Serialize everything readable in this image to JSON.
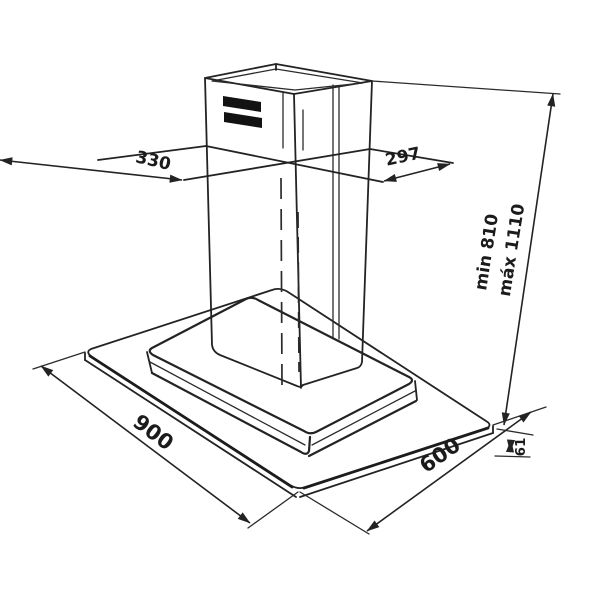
{
  "diagram": {
    "background": "#ffffff",
    "line_color": "#232323",
    "labels": {
      "top_width_left": "330",
      "top_width_right": "297",
      "base_length": "900",
      "base_depth": "600",
      "base_edge_thickness": "61",
      "height_min": "min 810",
      "height_max": "máx 1110"
    }
  }
}
